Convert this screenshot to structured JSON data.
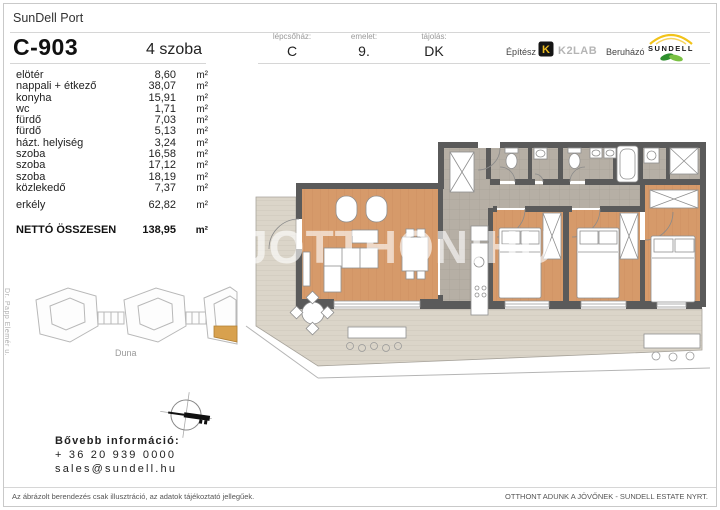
{
  "header": {
    "project": "SunDell Port",
    "unit_id": "C-903",
    "rooms_count": "4 szoba",
    "meta": [
      {
        "label": "lépcsőház:",
        "value": "C"
      },
      {
        "label": "emelet:",
        "value": "9."
      },
      {
        "label": "tájolás:",
        "value": "DK"
      }
    ],
    "partners": {
      "architect_label": "Építész",
      "architect_name": "K2LAB",
      "architect_logo_icon": "k2lab-mark",
      "developer_label": "Beruházó",
      "developer_name": "SUNDELL",
      "developer_logo_icon": "sundell-arc-leaf"
    }
  },
  "area_table": {
    "unit": "m²",
    "rows": [
      {
        "label": "elötér",
        "value": "8,60"
      },
      {
        "label": "nappali + étkező",
        "value": "38,07"
      },
      {
        "label": "konyha",
        "value": "15,91"
      },
      {
        "label": "wc",
        "value": "1,71"
      },
      {
        "label": "fürdő",
        "value": "7,03"
      },
      {
        "label": "fürdő",
        "value": "5,13"
      },
      {
        "label": "házt. helyiség",
        "value": "3,24"
      },
      {
        "label": "szoba",
        "value": "16,58"
      },
      {
        "label": "szoba",
        "value": "17,12"
      },
      {
        "label": "szoba",
        "value": "18,19"
      },
      {
        "label": "közlekedő",
        "value": "7,37"
      }
    ],
    "balcony_row": {
      "label": "erkély",
      "value": "62,82"
    },
    "total_row": {
      "label": "NETTÓ ÖSSZESEN",
      "value": "138,95"
    }
  },
  "site_map": {
    "street_label": "Dr. Papp Elemér u.",
    "river_label": "Duna",
    "compass_icon": "north-arrow"
  },
  "contact": {
    "heading": "Bővebb információ:",
    "phone": "+ 36 20 939 0000",
    "email": "sales@sundell.hu"
  },
  "footer": {
    "disclaimer": "Az ábrázolt berendezés csak illusztráció, az adatok tájékoztató jellegűek.",
    "slogan": "OTTHONT ADUNK A JÖVŐNEK - SUNDELL ESTATE NYRT."
  },
  "watermark": "UJOTTHON:HU",
  "colors": {
    "wall": "#5a5a5a",
    "wood_floor": "#d69a6a",
    "tile_floor": "#b6afa5",
    "balcony_deck": "#dbd5c9",
    "site_highlight": "#d8a14e",
    "k2lab_yellow": "#eebd20",
    "sundell_yellow": "#f2c319",
    "sundell_green": "#2f8f2f"
  }
}
